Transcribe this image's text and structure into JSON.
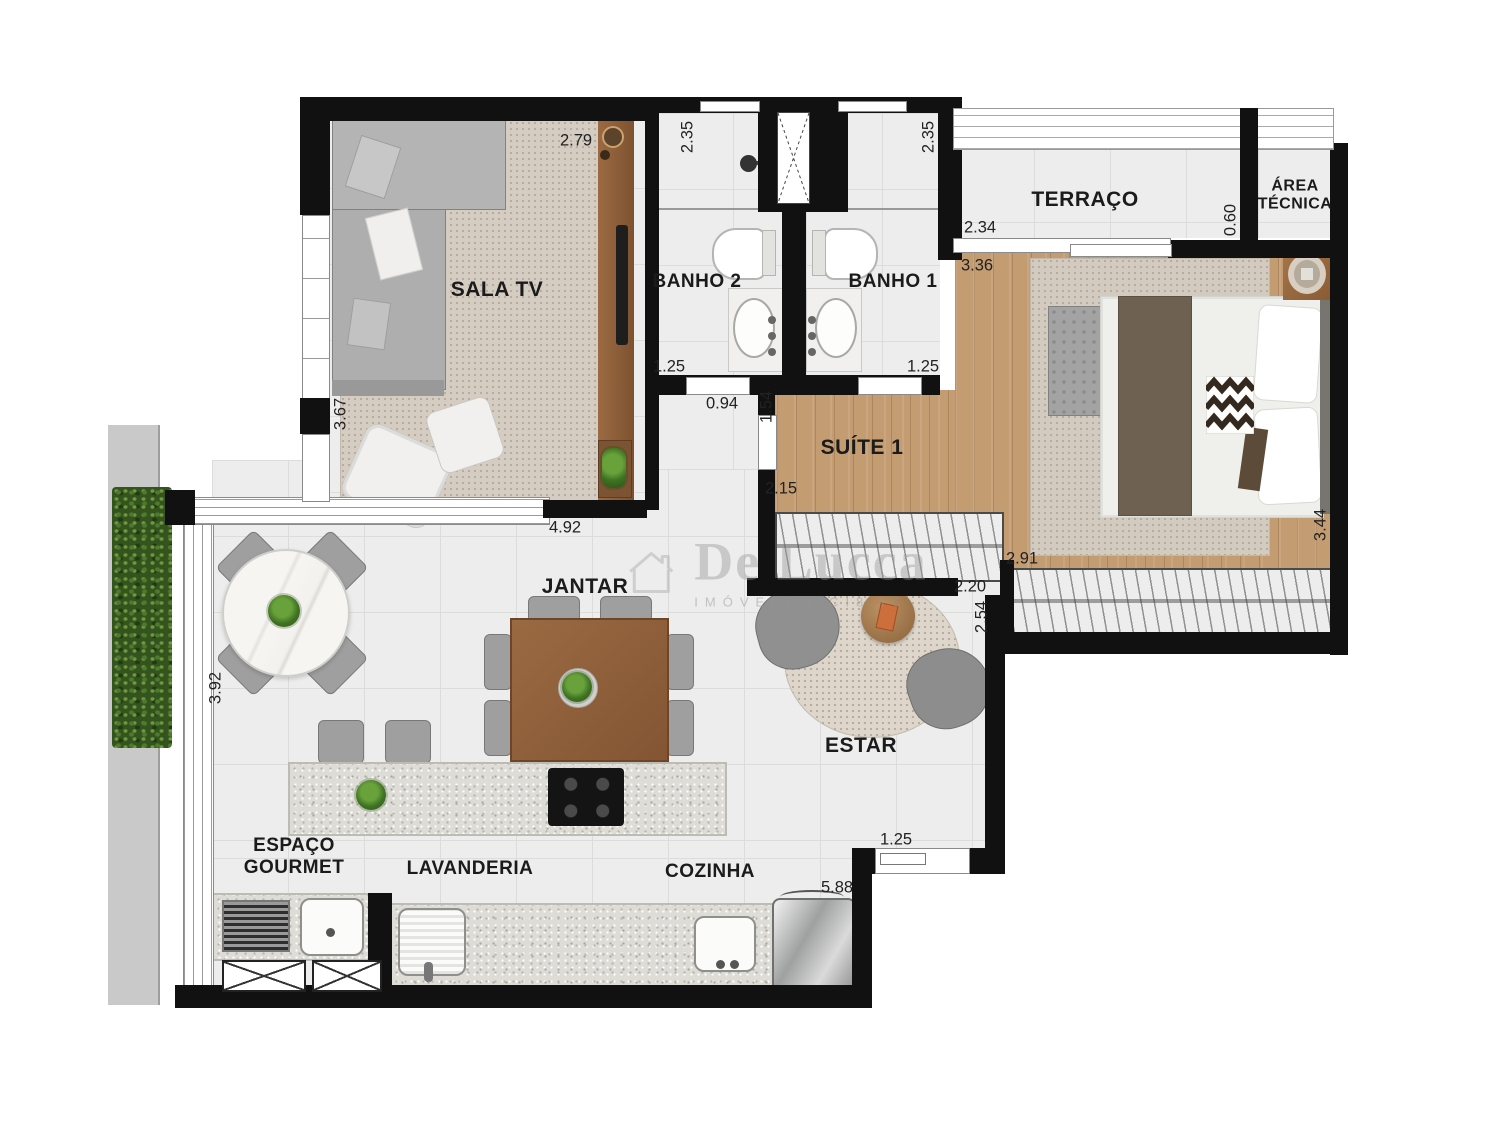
{
  "watermark": {
    "brand": "De Lucca",
    "tagline": "IMÓVEIS  |  CI8.IC"
  },
  "rooms": {
    "sala_tv": "SALA TV",
    "banho2": "BANHO 2",
    "banho1": "BANHO 1",
    "terraco": "TERRAÇO",
    "area_tecnica": "ÁREA TÉCNICA",
    "suite1": "SUÍTE 1",
    "jantar": "JANTAR",
    "estar": "ESTAR",
    "espaco_gourmet": "ESPAÇO GOURMET",
    "lavanderia": "LAVANDERIA",
    "cozinha": "COZINHA"
  },
  "dims": {
    "sala_w": "2.79",
    "sala_h": "3.67",
    "sala_opening": "4.92",
    "banho2_h": "2.35",
    "banho2_w": "1.25",
    "banho1_h": "2.35",
    "banho1_w": "1.25",
    "hall_w": "0.94",
    "hall_d": "1.54",
    "suite_door": "2.15",
    "terraco_w": "2.34",
    "suite_top_w": "3.36",
    "area_tecnica_d": "0.60",
    "suite_w": "2.91",
    "suite_d": "3.44",
    "estar_opening": "2.20",
    "estar_d": "2.54",
    "gourmet_d": "3.92",
    "cozinha_w": "5.88",
    "entry_w": "1.25"
  },
  "colors": {
    "wall": "#111111",
    "wood_floor": "#c49c72",
    "hedge": "#35531f"
  }
}
